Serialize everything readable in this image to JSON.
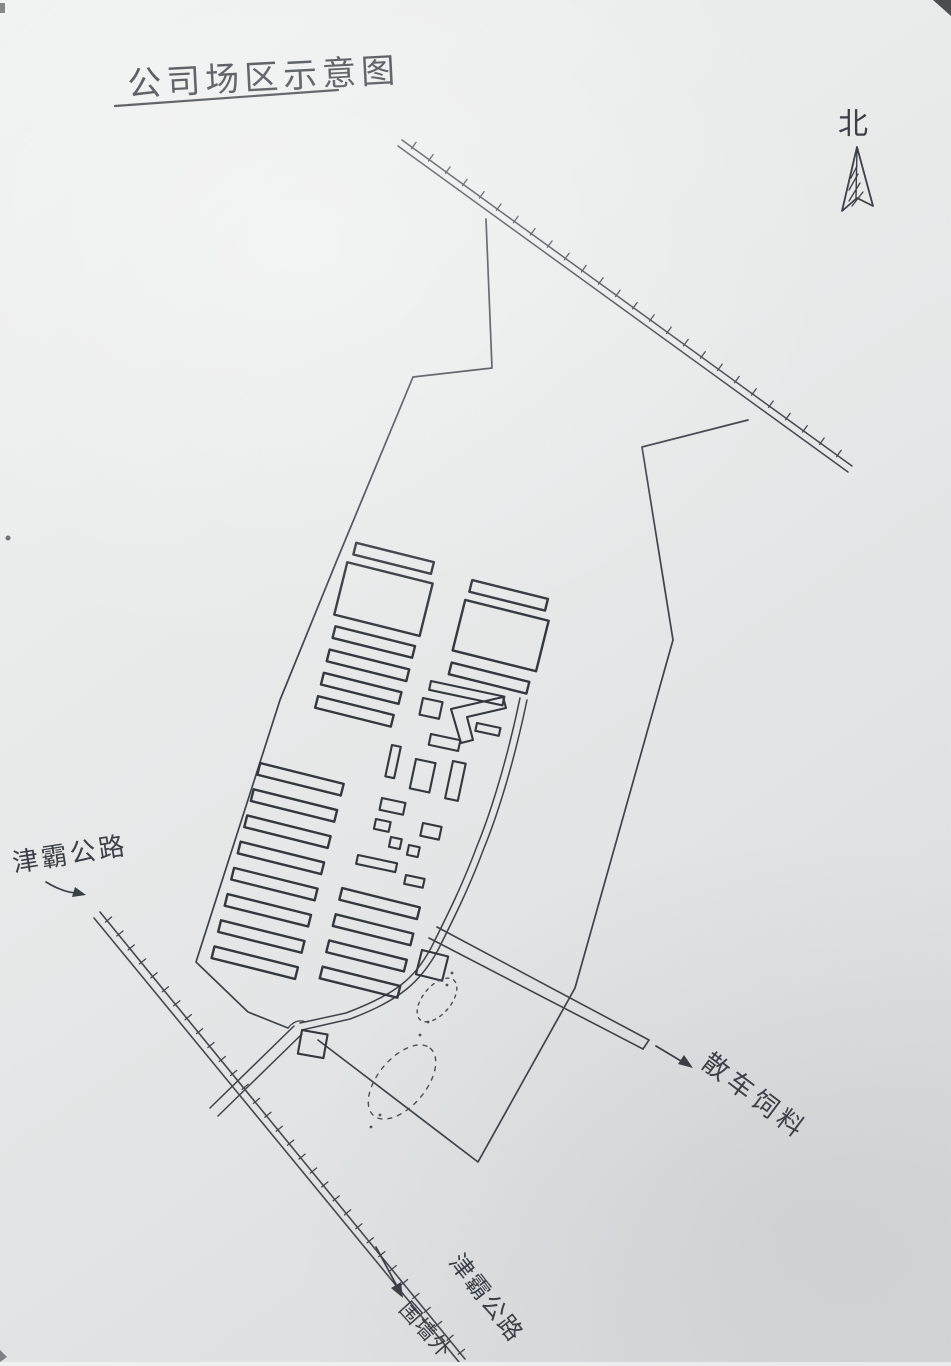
{
  "colors": {
    "paper_light": "#eef0f0",
    "paper_dark": "#d9dcde",
    "ink": "#3b4046"
  },
  "title": "公司场区示意图",
  "compass_label": "北",
  "road_labels": {
    "jinba_highway": "津霸公路",
    "jinba_highway_south": "津霸公路",
    "outside_wall_note": "围墙外",
    "bulk_feed_loading": "散车饲料"
  }
}
